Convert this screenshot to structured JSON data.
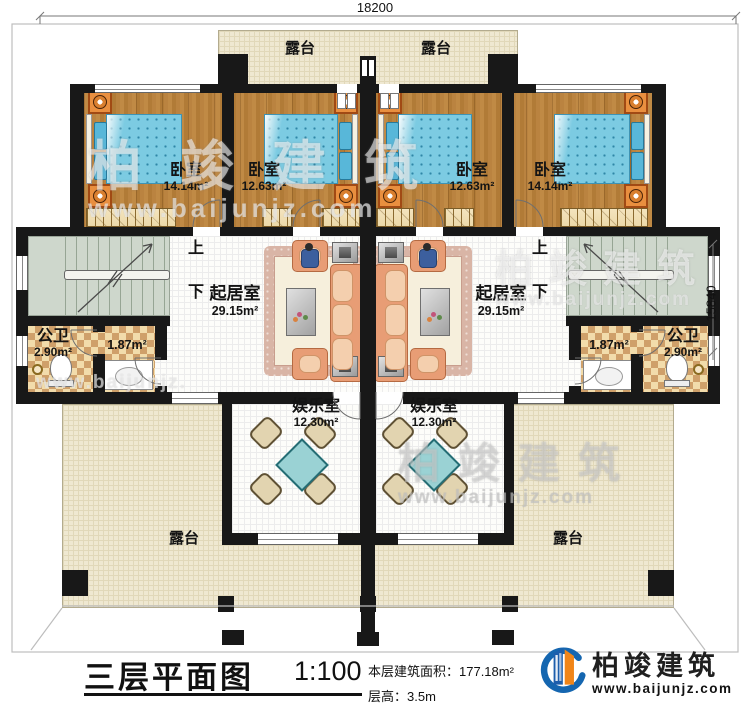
{
  "dimensions": {
    "top": "18200",
    "right": "15840"
  },
  "rooms": {
    "terraces": [
      {
        "label": "露台"
      },
      {
        "label": "露台"
      },
      {
        "label": "露台"
      },
      {
        "label": "露台"
      }
    ],
    "bedrooms": [
      {
        "name": "卧室",
        "area": "14.14m²"
      },
      {
        "name": "卧室",
        "area": "12.63m²"
      },
      {
        "name": "卧室",
        "area": "12.63m²"
      },
      {
        "name": "卧室",
        "area": "14.14m²"
      }
    ],
    "living": [
      {
        "name": "起居室",
        "area": "29.15m²"
      },
      {
        "name": "起居室",
        "area": "29.15m²"
      }
    ],
    "baths": [
      {
        "name": "公卫",
        "area": "2.90m²",
        "area2": "1.87m²"
      },
      {
        "name": "公卫",
        "area": "2.90m²",
        "area2": "1.87m²"
      }
    ],
    "entertainment": [
      {
        "name": "娱乐室",
        "area": "12.30m²"
      },
      {
        "name": "娱乐室",
        "area": "12.30m²"
      }
    ]
  },
  "stairs": {
    "up": "上",
    "down": "下"
  },
  "titleblock": {
    "title": "三层平面图",
    "scale": "1:100",
    "area_line": "本层建筑面积：177.18m²",
    "height_line": "层高：3.5m"
  },
  "brand": {
    "name": "柏竣建筑",
    "url": "www.baijunjz.com"
  },
  "watermark": {
    "name": "柏竣建筑",
    "url": "www.baijunjz.com"
  },
  "colors": {
    "wood": "#b5803d",
    "bed": "#7ccbe2",
    "terrace": "#efe8d1",
    "stair": "#ced7cc",
    "tile": "#cfa06a",
    "sofa": "#e89d75",
    "table": "#9ad2d4",
    "brand_blue": "#1566b0",
    "brand_orange": "#f08519"
  }
}
